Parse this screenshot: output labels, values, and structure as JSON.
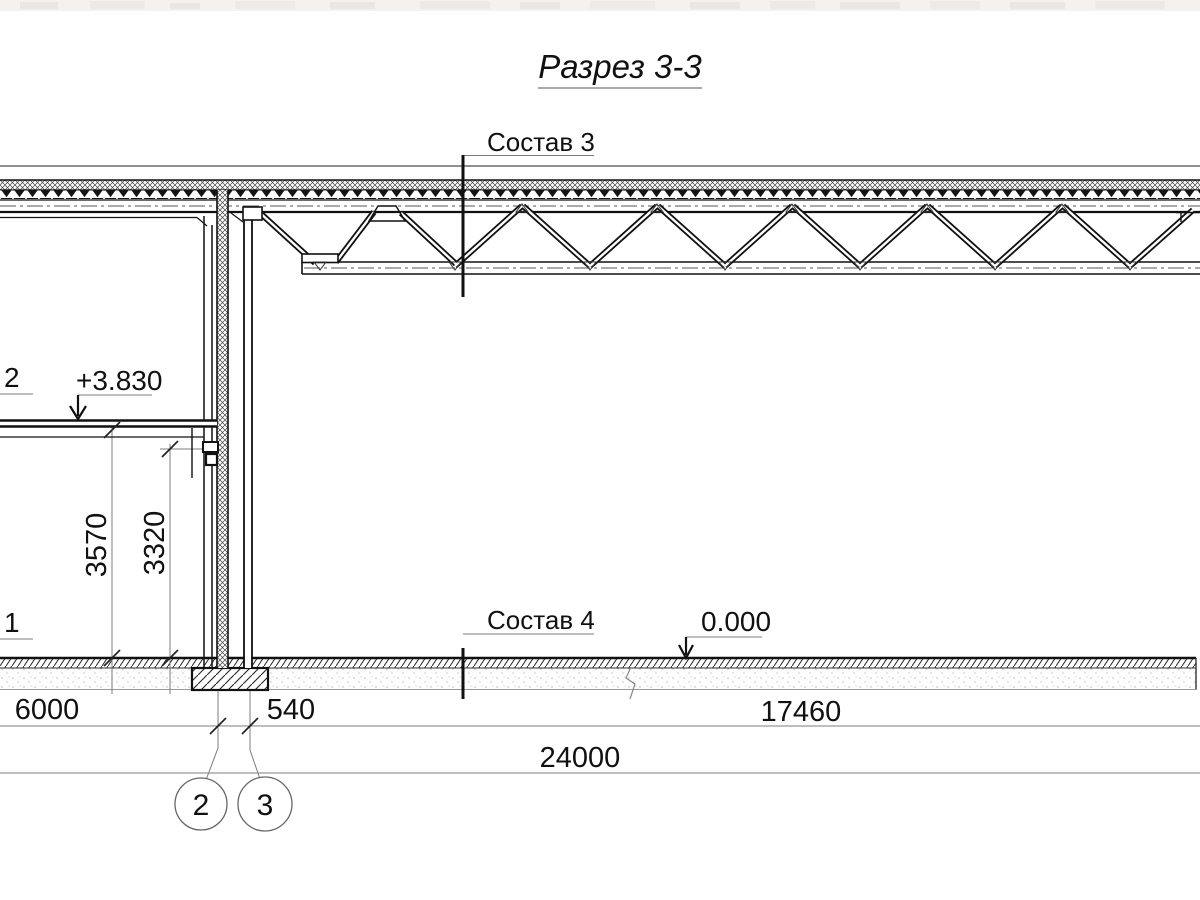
{
  "title": {
    "text": "Разрез 3-3"
  },
  "section_marks": {
    "roof": {
      "label": "Состав 3"
    },
    "floor": {
      "label": "Состав 4"
    }
  },
  "elevations": {
    "upper_slab": {
      "label": "+3.830"
    },
    "ground_floor": {
      "label": "0.000"
    }
  },
  "note_numbers": {
    "upper": {
      "label": "2"
    },
    "lower": {
      "label": "1"
    }
  },
  "dimensions": {
    "vertical": [
      {
        "label": "3570"
      },
      {
        "label": "3320"
      }
    ],
    "horizontal_row1": [
      {
        "label": "6000"
      },
      {
        "label": "540"
      },
      {
        "label": "17460"
      }
    ],
    "horizontal_row2": [
      {
        "label": "24000"
      }
    ]
  },
  "grid_axes": [
    {
      "label": "2"
    },
    {
      "label": "3"
    }
  ],
  "colors": {
    "main_line": "#111111",
    "thin_line": "#777777",
    "text": "#111111",
    "background": "#ffffff"
  }
}
